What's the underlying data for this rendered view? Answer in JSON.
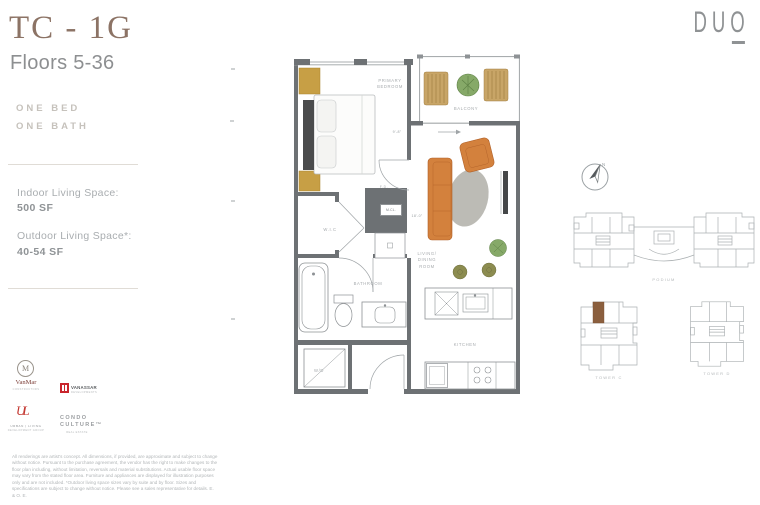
{
  "title": {
    "unit": "TC - 1G",
    "floors": "Floors 5-36"
  },
  "features": {
    "one_bed": "ONE BED",
    "one_bath": "ONE BATH"
  },
  "specs": {
    "indoor_label": "Indoor Living Space:",
    "indoor_value": "500 SF",
    "outdoor_label": "Outdoor Living Space*:",
    "outdoor_value": "40-54 SF"
  },
  "brand": {
    "name": "DUO"
  },
  "plan": {
    "labels": {
      "bedroom": "PRIMARY BEDROOM",
      "balcony": "BALCONY",
      "living": "LIVING/ DINING ROOM",
      "kitchen": "KITCHEN",
      "bathroom": "BATHROOM",
      "wic": "W.I.C",
      "mcl": "M.CL.",
      "wd": "W/D",
      "fd": "F.D."
    },
    "dimensions": {
      "bedroom_width": "9'-8\"",
      "living_width": "18'-0\""
    }
  },
  "compass": {
    "north": "N"
  },
  "keyplans": {
    "podium_label": "PODIUM",
    "tower_left_label": "TOWER C",
    "tower_right_label": "TOWER D"
  },
  "logos": {
    "vanmar": {
      "monogram": "M",
      "name": "VanMar",
      "sub": "CONSTRUCTORS"
    },
    "vanassar": {
      "name": "VANASSAR",
      "sub": "DEVELOPMENTS"
    },
    "urban": {
      "monogram": "UL",
      "name": "URBAN | LIVING",
      "sub": "DEVELOPMENT GROUP"
    },
    "condo_culture": {
      "line1": "CONDO",
      "line2": "CULTURE™",
      "sub": "REAL ESTATE"
    }
  },
  "colors": {
    "accent_brown": "#8C7365",
    "wall_gray": "#6D7174",
    "gold": "#C79F45",
    "sofa_orange": "#D3813D",
    "unit_highlight": "#8B5F3E",
    "logo_red": "#C9252C"
  },
  "disclaimer": "All renderings are artist's concept. All dimensions, if provided, are approximate and subject to change without notice. Pursuant to the purchase agreement, the vendor has the right to make changes to the floor plan including, without limitation, reversals and material substitutions. Actual usable floor space may vary from the stated floor area. Furniture and appliances are displayed for illustration purposes only and are not included. *Outdoor living space sizes vary by suite and by floor. Sizes and specifications are subject to change without notice. Please see a sales representative for details. E. & O. E."
}
